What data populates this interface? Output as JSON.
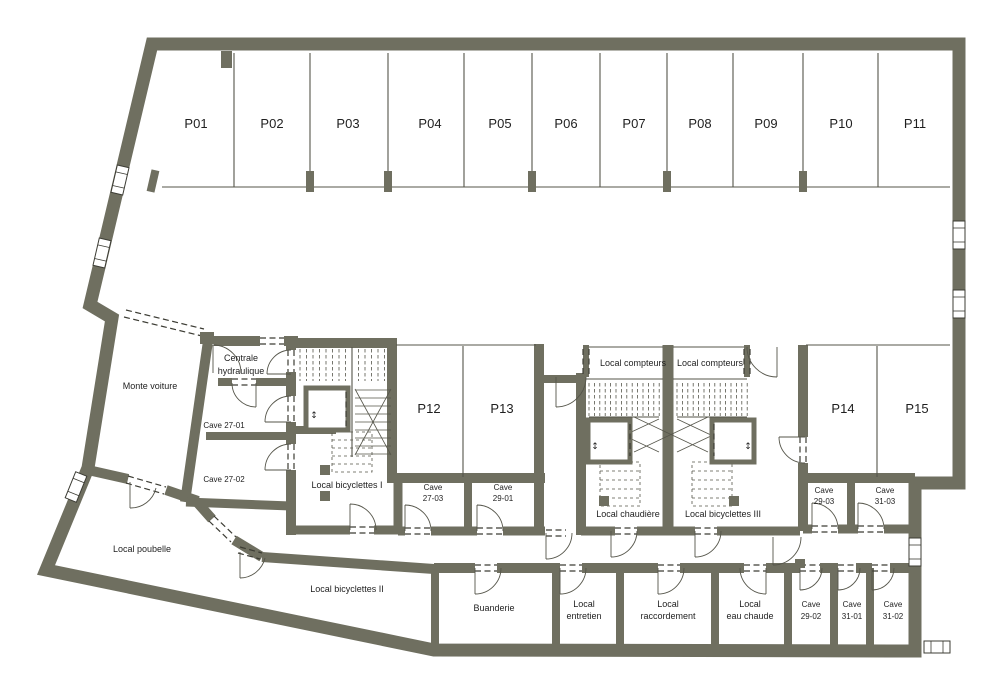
{
  "colors": {
    "wall": "#6f6f60",
    "line": "#55554a",
    "dash": "#3c3c34",
    "text": "#1f1f1f",
    "background": "#ffffff"
  },
  "parking": {
    "row_top": [
      "P01",
      "P02",
      "P03",
      "P04",
      "P05",
      "P06",
      "P07",
      "P08",
      "P09",
      "P10",
      "P11"
    ],
    "mid": [
      "P12",
      "P13"
    ],
    "right": [
      "P14",
      "P15"
    ]
  },
  "rooms": {
    "monte_voiture": "Monte voiture",
    "centrale_hydraulique": {
      "line1": "Centrale",
      "line2": "hydraulique"
    },
    "cave_27_01": "Cave 27-01",
    "cave_27_02": "Cave 27-02",
    "local_bicyclettes_1": "Local bicyclettes I",
    "cave_27_03": {
      "line1": "Cave",
      "line2": "27-03"
    },
    "cave_29_01": {
      "line1": "Cave",
      "line2": "29-01"
    },
    "local_compteurs_left": "Local compteurs",
    "local_compteurs_right": "Local compteurs",
    "local_chaudiere": "Local chaudière",
    "local_bicyclettes_3": "Local bicyclettes III",
    "cave_29_03": {
      "line1": "Cave",
      "line2": "29-03"
    },
    "cave_31_03": {
      "line1": "Cave",
      "line2": "31-03"
    },
    "local_poubelle": "Local poubelle",
    "local_bicyclettes_2": "Local bicyclettes II",
    "buanderie": "Buanderie",
    "local_entretien": {
      "line1": "Local",
      "line2": "entretien"
    },
    "local_raccordement": {
      "line1": "Local",
      "line2": "raccordement"
    },
    "local_eau_chaude": {
      "line1": "Local",
      "line2": "eau chaude"
    },
    "cave_29_02": {
      "line1": "Cave",
      "line2": "29-02"
    },
    "cave_31_01": {
      "line1": "Cave",
      "line2": "31-01"
    },
    "cave_31_02": {
      "line1": "Cave",
      "line2": "31-02"
    }
  },
  "icons": {
    "elevator_arrows": "↕"
  }
}
